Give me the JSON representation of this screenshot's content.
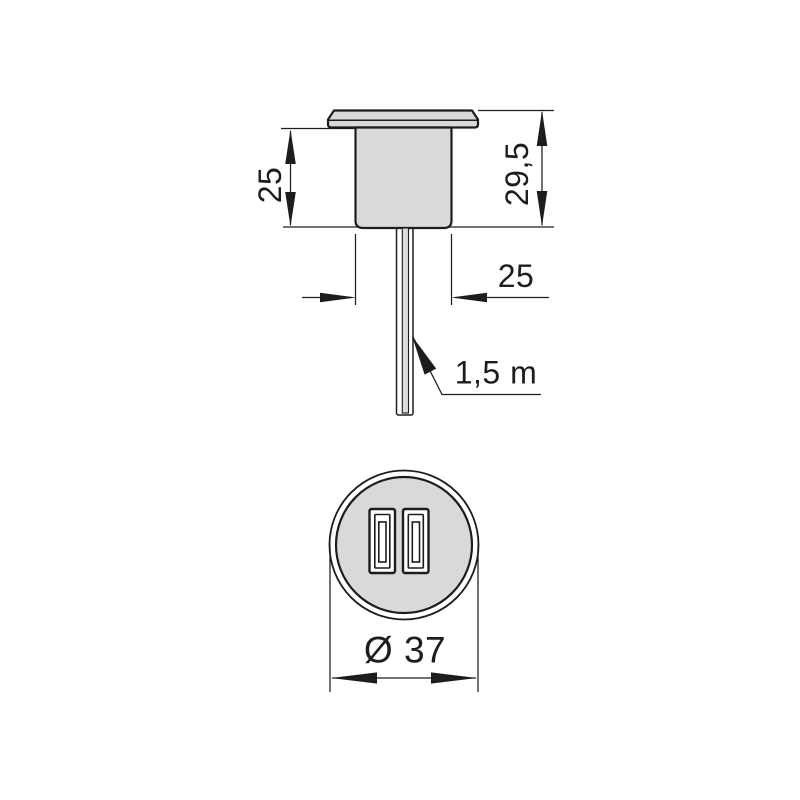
{
  "drawing": {
    "kind": "dimensioned technical drawing of recessed USB charger",
    "side_view": {
      "dim_body_height": "25",
      "dim_total_height": "29,5",
      "dim_body_width": "25",
      "dim_cable_length": "1,5 m"
    },
    "front_view": {
      "dim_diameter": "Ø 37",
      "usb_port_count": 2
    },
    "colors": {
      "background": "#ffffff",
      "line": "#1d1d1b",
      "part_fill": "#d9d9d9",
      "cable_outer_fill": "#f2f2f2",
      "cable_core_fill": "#dcdcdc",
      "port_fill": "#ffffff"
    }
  }
}
